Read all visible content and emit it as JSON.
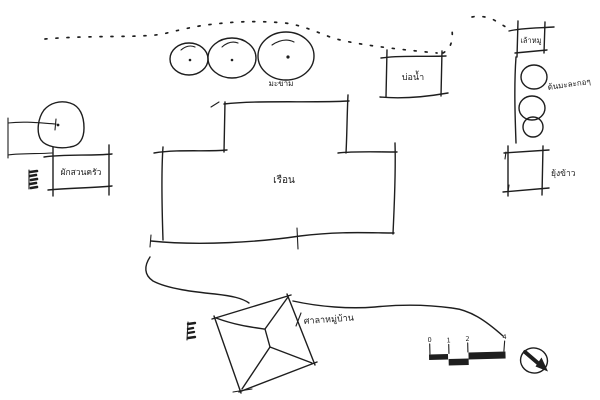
{
  "sketch": {
    "type": "hand-drawn site plan",
    "ink_color": "#1e1e1e",
    "paper_color": "#ffffff",
    "labels": {
      "tamarind_tree": "มะขาม",
      "kitchen_garden": "ผักสวนครัว",
      "house": "เรือน",
      "well": "บ่อน้ำ",
      "pig_pen": "เล้าหมู",
      "papaya_trees": "ต้นมะละกอๆ",
      "rice_barn": "ยุ้งข้าว",
      "village_pavilion": "ศาลาหมู่บ้าน"
    },
    "scale_bar": {
      "tick_labels": [
        "0",
        "1",
        "2",
        "4"
      ]
    }
  }
}
